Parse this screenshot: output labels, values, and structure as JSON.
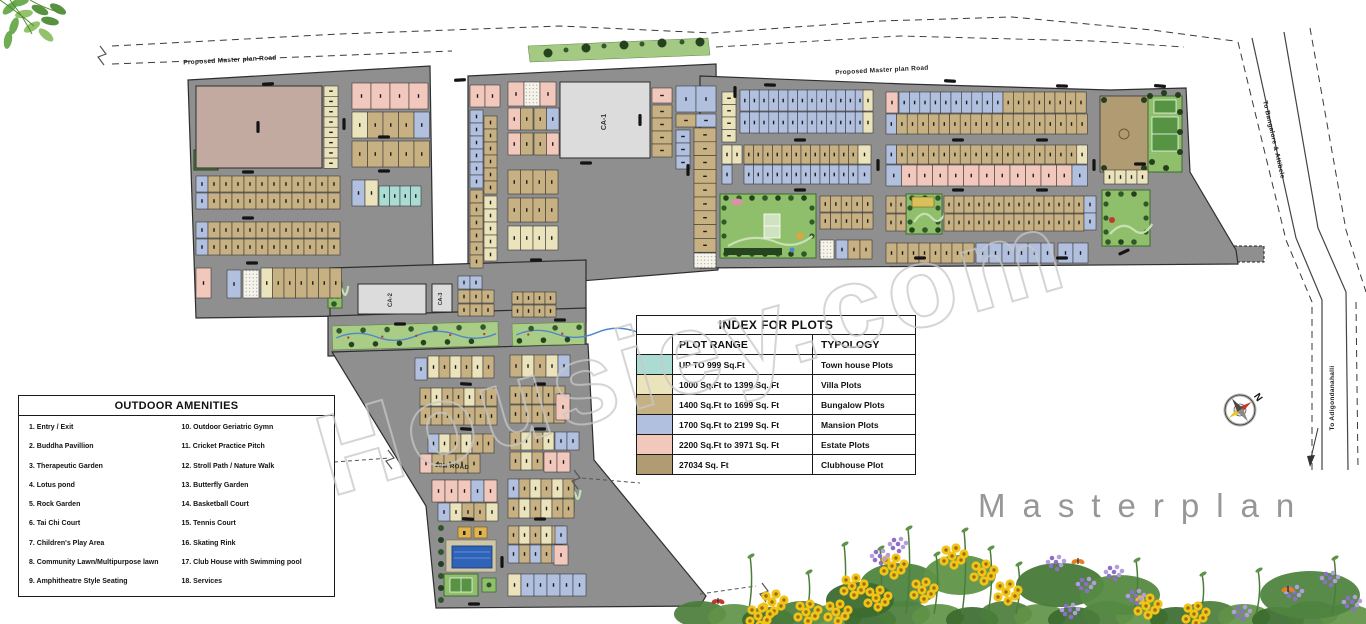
{
  "watermark": "Housiey.com",
  "masterplan_label": "Masterplan",
  "amenities": {
    "title": "OUTDOOR AMENITIES",
    "items": [
      "1. Entry / Exit",
      "2. Buddha Pavillion",
      "3. Therapeutic Garden",
      "4. Lotus pond",
      "5. Rock Garden",
      "6. Tai Chi Court",
      "7. Children's Play Area",
      "8. Community Lawn/Multipurpose lawn",
      "9. Amphitheatre Style Seating",
      "10. Outdoor Geriatric Gymn",
      "11. Cricket Practice Pitch",
      "12. Stroll Path / Nature Walk",
      "13. Butterfly Garden",
      "14. Basketball Court",
      "15. Tennis Court",
      "16. Skating Rink",
      "17. Club House with Swimming pool",
      "18. Services"
    ]
  },
  "index_table": {
    "title": "INDEX FOR PLOTS",
    "columns": [
      "PLOT RANGE",
      "TYPOLOGY"
    ],
    "rows": [
      {
        "swatch": "#abdcd3",
        "range": "UP TO 999 Sq.Ft",
        "typology": "Town house Plots"
      },
      {
        "swatch": "#ebe3bb",
        "range": "1000 Sq.Ft to 1399 Sq. Ft",
        "typology": "Villa Plots"
      },
      {
        "swatch": "#c7b183",
        "range": "1400 Sq.Ft to 1699 Sq. Ft",
        "typology": "Bungalow Plots"
      },
      {
        "swatch": "#b2c0df",
        "range": "1700 Sq.Ft to 2199 Sq. Ft",
        "typology": "Mansion Plots"
      },
      {
        "swatch": "#f2c8bd",
        "range": "2200 Sq.Ft to 3971 Sq. Ft",
        "typology": "Estate Plots"
      },
      {
        "swatch": "#b19b72",
        "range": "27034 Sq. Ft",
        "typology": "Clubhouse Plot"
      }
    ]
  },
  "map_labels": {
    "proposed_road": "Proposed Master plan Road",
    "road_18m": "18M ROAD",
    "ca1": "CA-1",
    "ca2": "CA-2",
    "ca3": "CA-3",
    "to_north_east": "To Bangalore & Attibele",
    "to_south": "To Adigondanahalli",
    "compass_north": "N"
  },
  "palette": {
    "road": "#8f8f8f",
    "townhouse": "#abdcd3",
    "villa": "#ebe3bb",
    "bungalow": "#c7b183",
    "mansion": "#b2c0df",
    "estate": "#f2c8bd",
    "clubhouse": "#b19b72",
    "big_plot": "#c2aaa0",
    "common_area": "#dcdcdc",
    "park": "#8fbf6a",
    "park_dark": "#2c5226",
    "pool": "#2f63b8",
    "watermark_gray": "#c8c8c8"
  }
}
